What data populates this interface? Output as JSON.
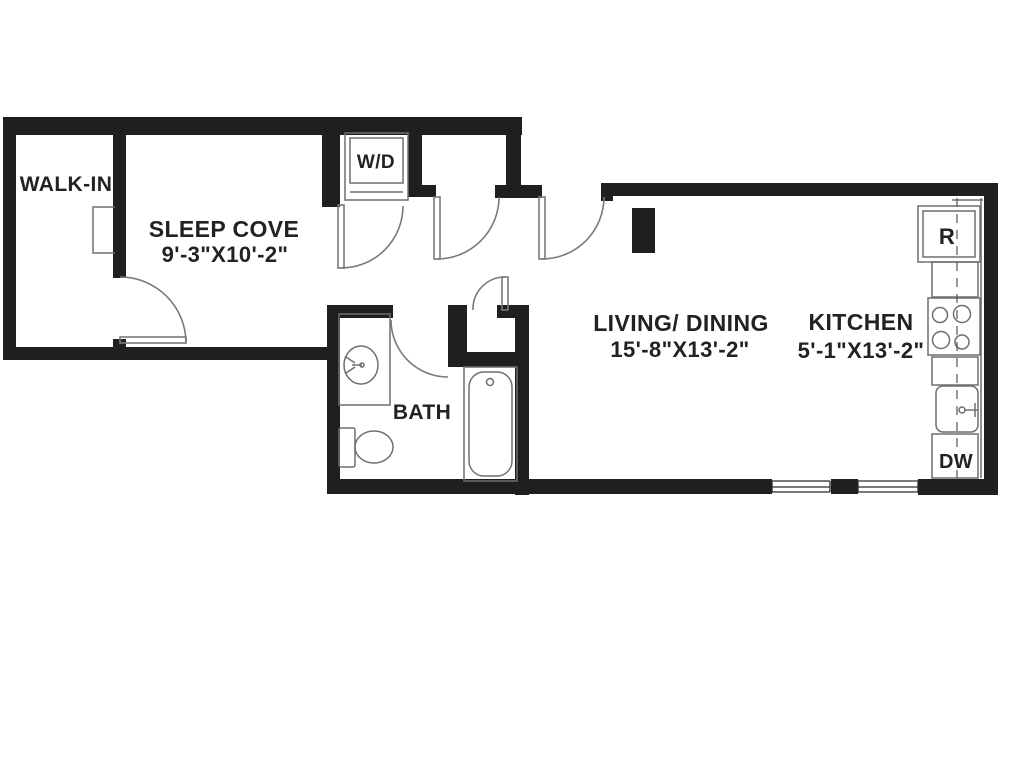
{
  "floor_plan": {
    "colors": {
      "wall": "#1f1f1f",
      "fixture_line": "#6f6f6f",
      "door_line": "#7a7a7a",
      "window_line": "#2a2a2a",
      "dash_line": "#555555",
      "text": "#222222",
      "background": "#ffffff"
    },
    "rooms": {
      "walk_in": {
        "label": "WALK-IN"
      },
      "sleep_cove": {
        "label": "SLEEP COVE",
        "dimensions": "9'-3\"X10'-2\""
      },
      "bath": {
        "label": "BATH"
      },
      "living_dining": {
        "label": "LIVING/ DINING",
        "dimensions": "15'-8\"X13'-2\""
      },
      "kitchen": {
        "label": "KITCHEN",
        "dimensions": "5'-1\"X13'-2\""
      }
    },
    "appliances": {
      "washer_dryer_label": "W/D",
      "refrigerator_label": "R",
      "dishwasher_label": "DW"
    }
  }
}
